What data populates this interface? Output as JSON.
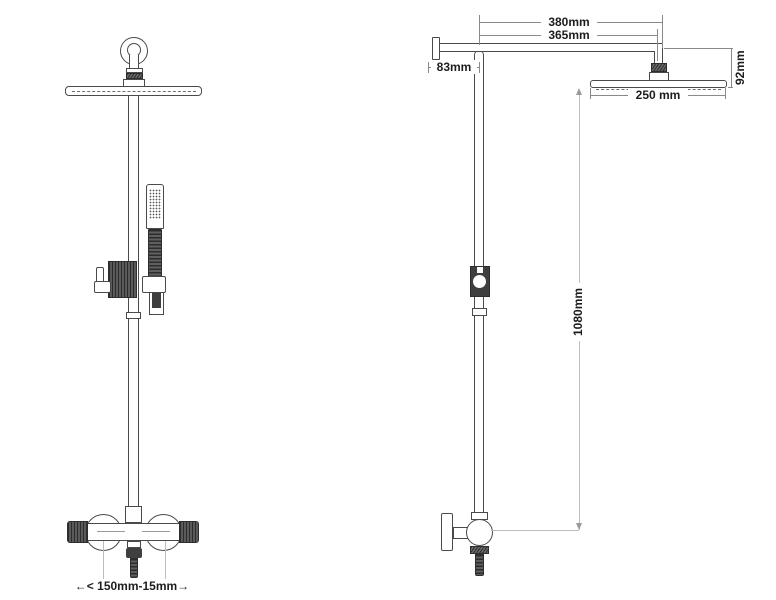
{
  "dimensions": {
    "arm_length": "380mm",
    "arm_reach": "365mm",
    "wall_offset": "83mm",
    "head_drop": "92mm",
    "head_width": "250 mm",
    "riser_height": "1080mm",
    "inlet_spacing": "←< 150mm-15mm→"
  },
  "colors": {
    "background": "#ffffff",
    "line": "#4a4a4a",
    "dimension_line": "#8a8a8a",
    "light_dimension_line": "#bdbdbd",
    "dark_fill": "#3f3f3f",
    "label_text": "#1d1d1d"
  }
}
